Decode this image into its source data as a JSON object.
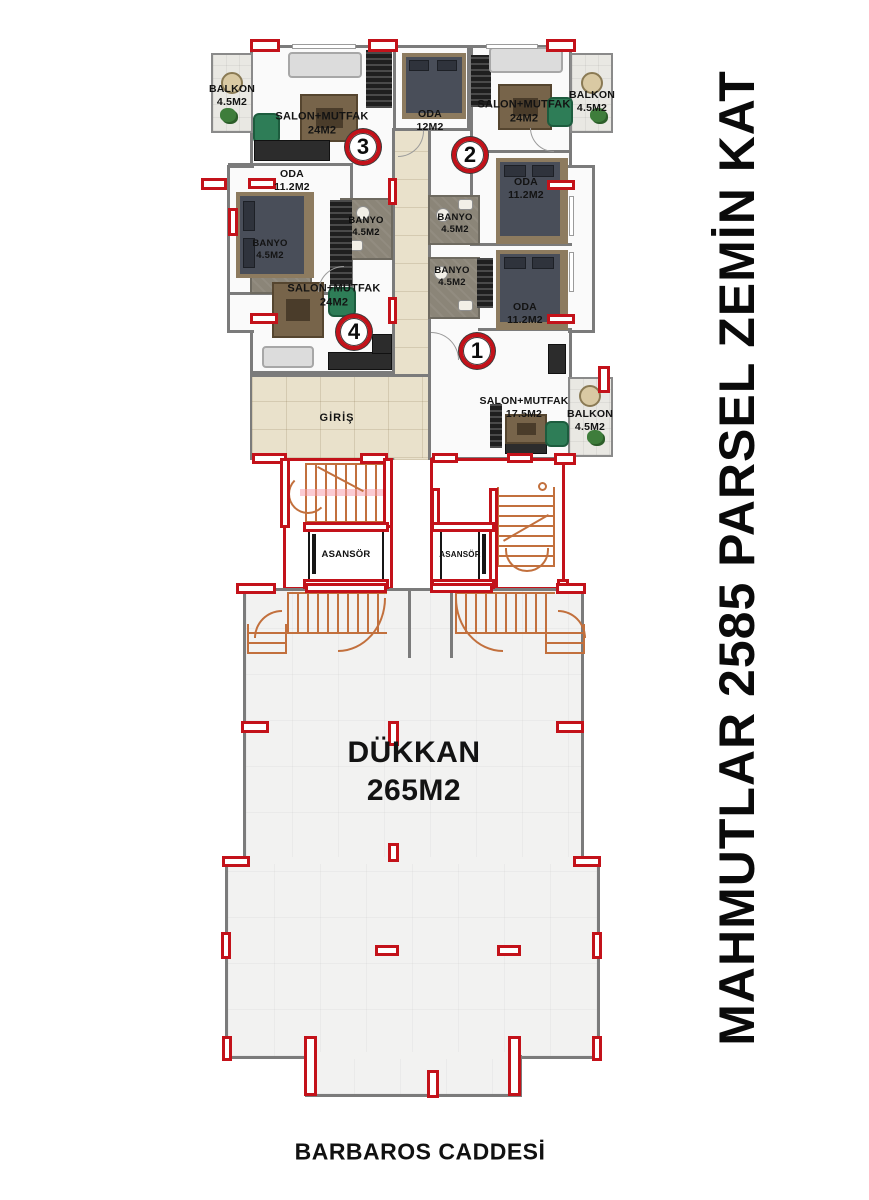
{
  "title": {
    "side_label": "MAHMUTLAR 2585 PARSEL ZEMİN KAT",
    "street_label": "BARBAROS CADDESİ"
  },
  "units": {
    "u1": "1",
    "u2": "2",
    "u3": "3",
    "u4": "4"
  },
  "rooms": {
    "balkon_tl": {
      "name": "BALKON",
      "area": "4.5M2"
    },
    "balkon_tr": {
      "name": "BALKON",
      "area": "4.5M2"
    },
    "balkon_br": {
      "name": "BALKON",
      "area": "4.5M2"
    },
    "salon3": {
      "name": "SALON+MUTFAK",
      "area": "24M2"
    },
    "salon2": {
      "name": "SALON+MUTFAK",
      "area": "24M2"
    },
    "salon4": {
      "name": "SALON+MUTFAK",
      "area": "24M2"
    },
    "salon1": {
      "name": "SALON+MUTFAK",
      "area": "17.5M2"
    },
    "oda12": {
      "name": "ODA",
      "area": "12M2"
    },
    "oda3": {
      "name": "ODA",
      "area": "11.2M2"
    },
    "oda2": {
      "name": "ODA",
      "area": "11.2M2"
    },
    "oda1": {
      "name": "ODA",
      "area": "11.2M2"
    },
    "banyo3": {
      "name": "BANYO",
      "area": "4.5M2"
    },
    "banyo2": {
      "name": "BANYO",
      "area": "4.5M2"
    },
    "banyo4": {
      "name": "BANYO",
      "area": "4.5M2"
    },
    "banyo1": {
      "name": "BANYO",
      "area": "4.5M2"
    },
    "giris": {
      "name": "GİRİŞ"
    },
    "asansor_left": {
      "name": "ASANSÖR"
    },
    "asansor_right": {
      "name": "ASANSÖR"
    },
    "dukkan": {
      "name": "DÜKKAN",
      "area": "265M2"
    }
  },
  "colors": {
    "column_red": "#c3121a",
    "stair_orange": "#c2703d",
    "corridor_beige": "#e9e1cb",
    "wall_gray": "#7b7b7b"
  }
}
